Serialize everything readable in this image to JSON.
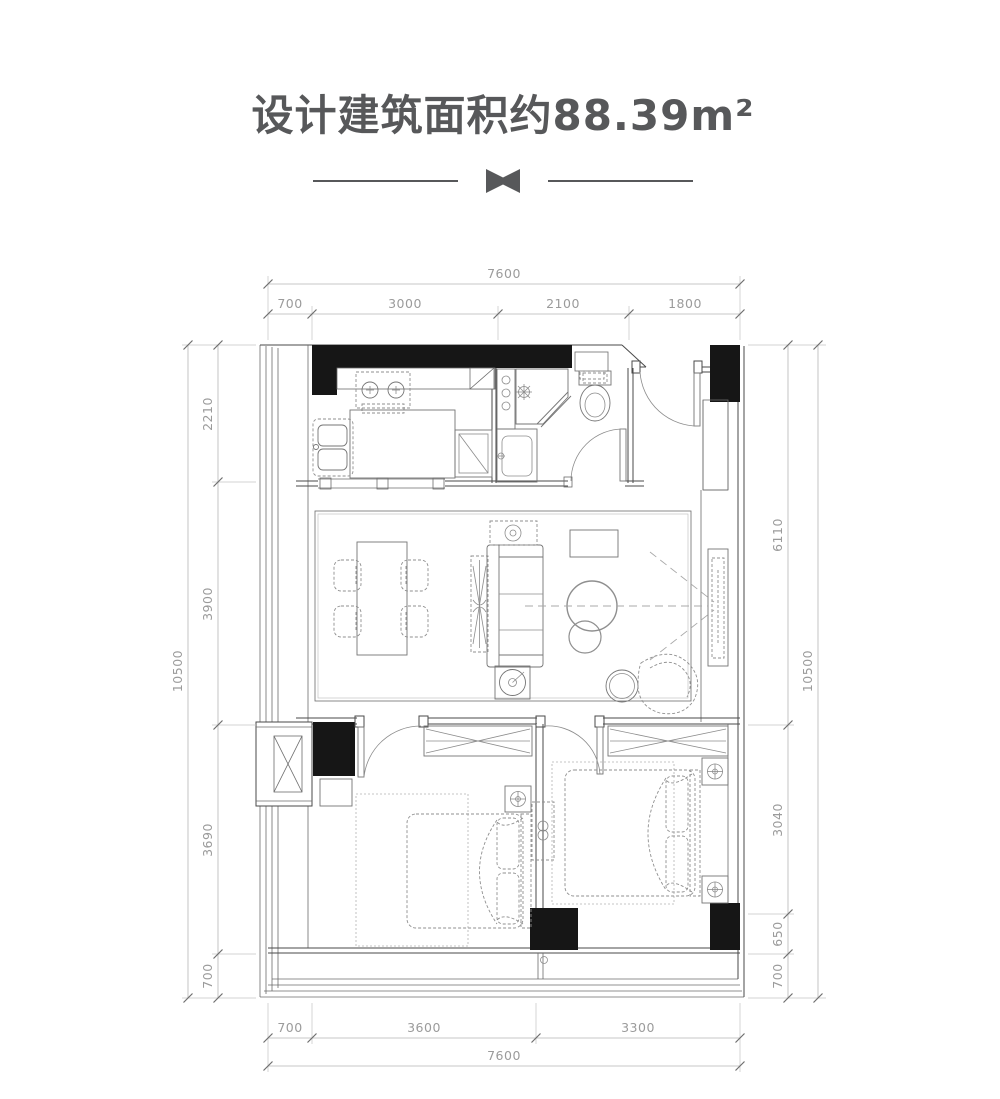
{
  "header": {
    "title": "设计建筑面积约88.39m²"
  },
  "dims": {
    "top": {
      "total": "7600",
      "segs": [
        "700",
        "3000",
        "2100",
        "1800"
      ]
    },
    "bottom": {
      "total": "7600",
      "segs": [
        "700",
        "3600",
        "3300"
      ]
    },
    "left": {
      "total": "10500",
      "segs": [
        "2210",
        "3900",
        "3690",
        "700"
      ]
    },
    "right": {
      "total": "10500",
      "segs": [
        "6110",
        "3040",
        "650",
        "700"
      ]
    }
  },
  "colors": {
    "title": "#57585a",
    "wall_fill": "#161616",
    "plan_line": "#4a4a4a",
    "dimension_text": "#9b9b9b",
    "background": "#ffffff"
  }
}
